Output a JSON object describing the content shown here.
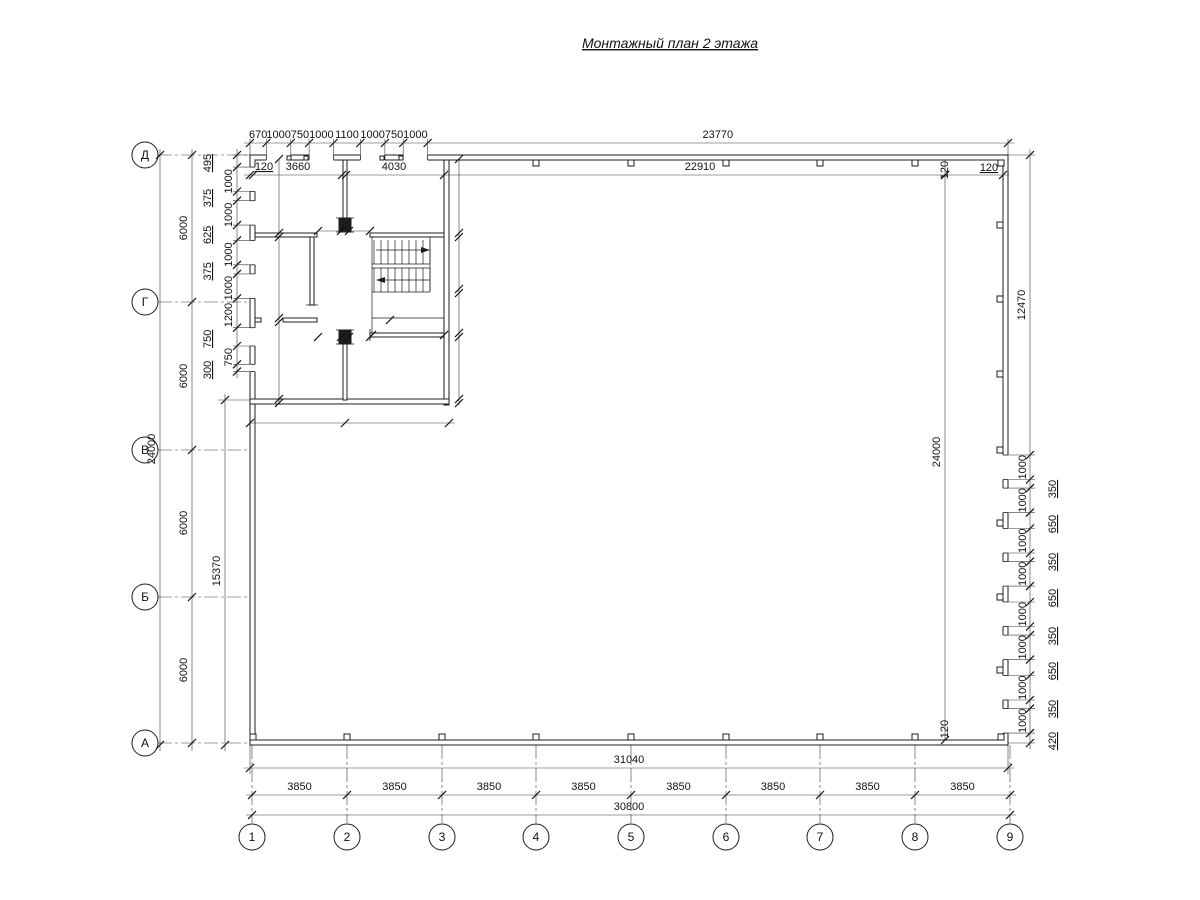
{
  "title": "Монтажный план 2 этажа",
  "grid": {
    "rows": [
      "Д",
      "Г",
      "В",
      "Б",
      "А"
    ],
    "cols": [
      "1",
      "2",
      "3",
      "4",
      "5",
      "6",
      "7",
      "8",
      "9"
    ]
  },
  "dims": {
    "top_chain": [
      "670",
      "1000",
      "750",
      "1000",
      "1100",
      "1000",
      "750",
      "1000",
      "23770"
    ],
    "top_row2": [
      "120",
      "3660",
      "4030",
      "22910"
    ],
    "wall120_top_rot": "120",
    "wall120_top": "120",
    "wall120_bottom_rot": "120",
    "left_total": "24000",
    "left_bays": [
      "6000",
      "6000",
      "6000",
      "6000"
    ],
    "left_inner_total": "15370",
    "left_chain": [
      "495",
      "1000",
      "375",
      "1000",
      "625",
      "1000",
      "375",
      "1000",
      "1200",
      "750",
      "750",
      "300"
    ],
    "right_outer_total": "12470",
    "right_inner_total": "24000",
    "right_windows": [
      "1000",
      "1000",
      "1000",
      "1000",
      "1000",
      "1000",
      "1000",
      "1000"
    ],
    "right_piers": [
      "350",
      "650",
      "350",
      "650",
      "350",
      "650",
      "350",
      "420"
    ],
    "bottom_outer_total": "31040",
    "bottom_bays": [
      "3850",
      "3850",
      "3850",
      "3850",
      "3850",
      "3850",
      "3850",
      "3850"
    ],
    "bottom_inner_total": "30800",
    "interior": {
      "wall_thk_a": "100",
      "wall_thk_b": "100",
      "grid2_cluster": [
        "100",
        "110",
        "900",
        "900"
      ],
      "left_heights": [
        "3200",
        "100",
        "3450",
        "100",
        "3150"
      ],
      "left_door": [
        "200",
        "900"
      ],
      "right_heights": [
        "3200",
        "100",
        "2150",
        "100",
        "1800",
        "100",
        "2550",
        "100"
      ],
      "stair_door": [
        "900",
        "100"
      ],
      "mid_wall": [
        "100",
        "2820"
      ],
      "mid_cluster": [
        "900",
        "900",
        "100",
        "100"
      ],
      "bottom_widths": [
        "3670",
        "4020"
      ],
      "bottom_thk": [
        "100",
        "100"
      ]
    }
  }
}
